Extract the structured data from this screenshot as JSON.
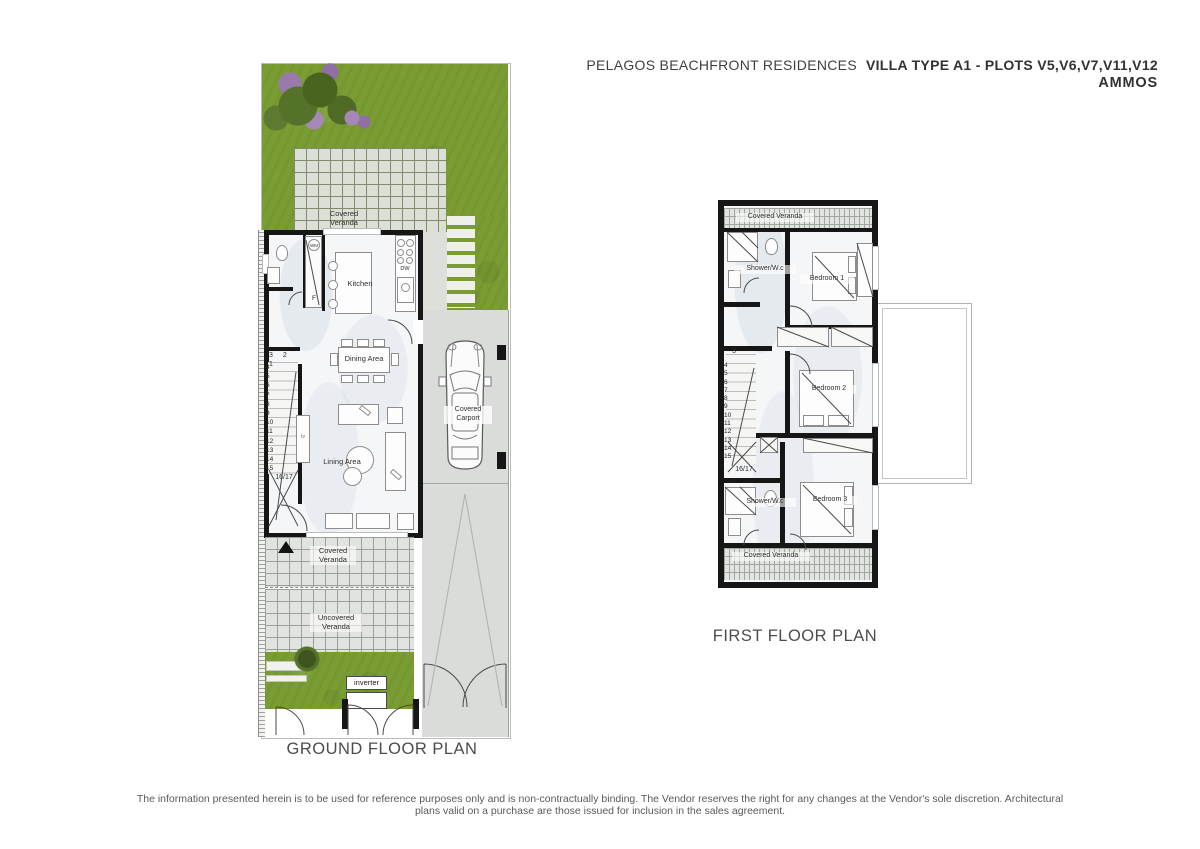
{
  "title": {
    "project": "PELAGOS BEACHFRONT RESIDENCES",
    "villa": "VILLA TYPE A1 - PLOTS V5,V6,V7,V11,V12",
    "brand": "AMMOS"
  },
  "ground_floor": {
    "caption": "GROUND FLOOR PLAN",
    "labels": {
      "covered_veranda_top": "Covered Veranda",
      "kitchen": "Kitchen",
      "dining": "Dining Area",
      "living": "Lining Area",
      "covered_veranda_bottom": "Covered Veranda",
      "uncovered_veranda": "Uncovered Veranda",
      "carport": "Covered Carport",
      "inverter": "inverter",
      "wm": "WM",
      "fridge": "F",
      "dishwasher": "DW",
      "tv": "tv"
    },
    "stairs": {
      "top": "3 2 1",
      "steps": [
        "4",
        "5",
        "6",
        "7",
        "8",
        "9",
        "10",
        "11",
        "12",
        "13",
        "14",
        "15"
      ],
      "bottom": "16/17"
    }
  },
  "first_floor": {
    "caption": "FIRST FLOOR PLAN",
    "labels": {
      "covered_veranda_top": "Covered Veranda",
      "shower_wc_1": "Shower/W.c",
      "bedroom1": "Bedroom 1",
      "bedroom2": "Bedroom 2",
      "bedroom3": "Bedroom 3",
      "shower_wc_2": "Shower/W.c",
      "covered_veranda_bottom": "Covered Veranda"
    },
    "stairs": {
      "top": "3",
      "steps": [
        "4",
        "5",
        "6",
        "7",
        "8",
        "9",
        "10",
        "11",
        "12",
        "13",
        "14",
        "15"
      ],
      "bottom": "16/17"
    }
  },
  "disclaimer": {
    "line1": "The information presented herein is to be used for reference purposes only and is non-contractually binding.  The Vendor reserves the right for any changes at the Vendor's sole discretion.  Architectural",
    "line2": "plans valid on a purchase are those issued for inclusion in the sales agreement."
  },
  "colors": {
    "grass": "#7a9d33",
    "tile": "#e0e3df",
    "tile_line": "#98a098",
    "wall": "#161616",
    "floor": "#f4f6f8",
    "flowers": "#a083b8",
    "driveway": "#dadcd9"
  }
}
